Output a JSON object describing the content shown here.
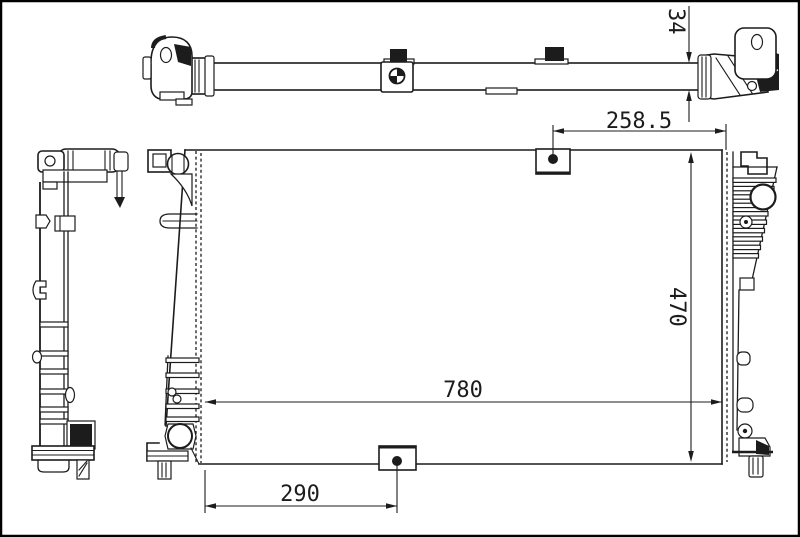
{
  "drawing": {
    "type": "radiator-technical-drawing",
    "background_color": "#ffffff",
    "line_color": "#1c1c1c",
    "dimensions": {
      "tank_thickness": {
        "value": "34",
        "orientation": "vertical"
      },
      "top_bracket_to_right_edge": {
        "value": "258.5",
        "orientation": "horizontal"
      },
      "overall_height": {
        "value": "470",
        "orientation": "vertical"
      },
      "overall_width": {
        "value": "780",
        "orientation": "horizontal"
      },
      "left_edge_to_bottom_bracket": {
        "value": "290",
        "orientation": "horizontal"
      }
    }
  }
}
